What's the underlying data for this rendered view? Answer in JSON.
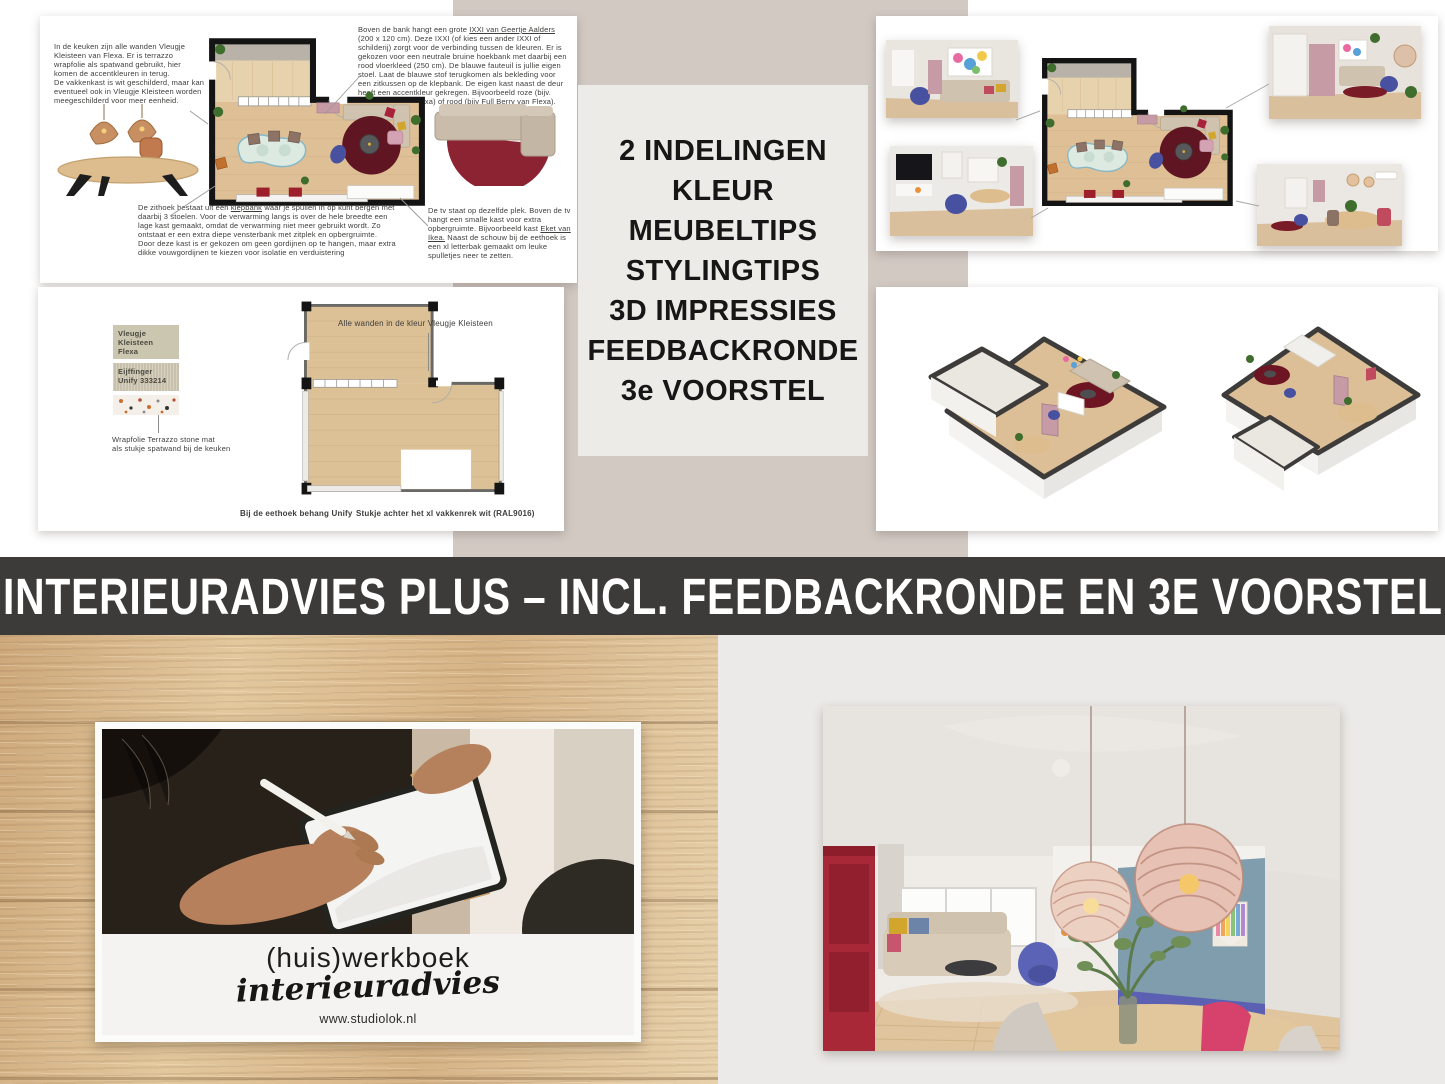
{
  "banner": {
    "title": "INTERIEURADVIES PLUS – INCL. FEEDBACKRONDE EN 3E VOORSTEL",
    "background": "#3D3B3A",
    "text_color": "#FFFFFF"
  },
  "package_box": {
    "background": "#EDEBE8",
    "items": [
      "2 INDELINGEN",
      "KLEUR",
      "MEUBELTIPS",
      "STYLINGTIPS",
      "3D IMPRESSIES",
      "FEEDBACKRONDE",
      "3e VOORSTEL"
    ]
  },
  "advice_slide": {
    "kitchen_note": "In de keuken zijn alle wanden Vleugje Kleisteen van Flexa. Er is terrazzo wrapfolie als spatwand gebruikt, hier komen de accentkleuren in terug.\nDe vakkenkast is wit geschilderd, maar kan eventueel ook in Vleugje Kleisteen worden meegeschilderd voor meer eenheid.",
    "sofa_note": {
      "pre": "Boven de bank hangt een grote ",
      "underlined": "IXXI van Geertje Aalders",
      "post": " (200 x 120 cm). Deze IXXI (of kies een ander IXXI of schilderij) zorgt voor de verbinding tussen de kleuren. Er is gekozen voor een neutrale bruine hoekbank met daarbij een rood vloerkleed (250 cm). De blauwe fauteuil is jullie eigen stoel. Laat de blauwe stof terugkomen als bekleding voor een zitkussen op de klepbank. De eigen kast naast de deur heeft een accentkleur gekregen. Bijvoorbeeld roze (bijv. Calm Berry van Flexa) of rood (bijv Full Berry van Flexa)."
    },
    "seating_note": {
      "pre": "De zithoek bestaat uit een ",
      "underlined": "klepbank",
      "post": " waar je spullen in op kunt bergen met daarbij 3 stoelen. Voor de verwarming langs is over de hele breedte een lage kast gemaakt, omdat de verwarming niet meer gebruikt wordt. Zo ontstaat er een extra diepe vensterbank met zitplek en opbergruimte. Door deze kast is er gekozen om geen gordijnen op te hangen, maar extra dikke vouwgordijnen te kiezen voor isolatie en verduistering"
    },
    "tv_note": {
      "pre": "De tv staat op dezelfde plek. Boven de tv hangt een smalle kast voor extra opbergruimte. Bijvoorbeeld kast ",
      "underlined": "Eket van Ikea.",
      "post": " Naast de schouw bij de eethoek is een xl letterbak gemaakt om leuke spulletjes neer te zetten."
    }
  },
  "color_slide": {
    "swatch1_label": "Vleugje Kleisteen\nFlexa",
    "swatch2_label": "Eijffinger\nUnify 333214",
    "terrazzo_caption": "Wrapfolie Terrazzo stone mat\nals stukje spatwand bij de keuken",
    "walls_annotation": "Alle wanden in de kleur Vleugje Kleisteen",
    "caption_dining": "Bij de eethoek behang Unify",
    "caption_shelf": "Stukje achter het xl vakkenrek wit (RAL9016)"
  },
  "workbook_card": {
    "title": "(huis)werkboek",
    "subtitle": "interieuradvies",
    "website": "www.studiolok.nl"
  },
  "palette": {
    "taupe_band": "#D2C9C3",
    "bottom_right_bg": "#ECEAE8",
    "floor_wood": "#DDBE92",
    "accent_red": "#9E1F2C",
    "accent_blue": "#4751A0",
    "accent_pink": "#D3A3B3"
  }
}
